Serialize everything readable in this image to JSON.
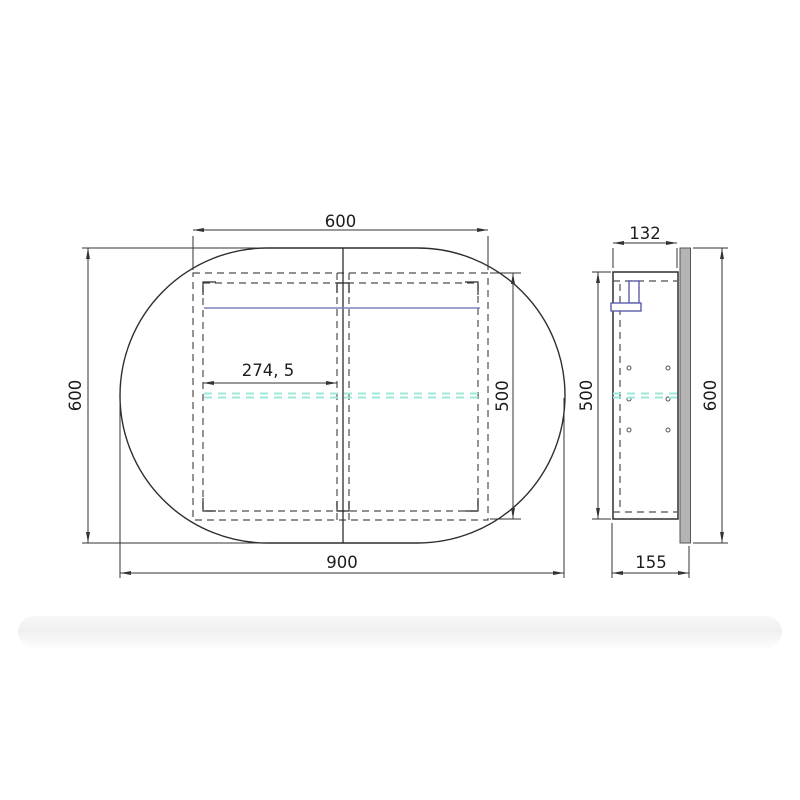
{
  "front_view": {
    "dims": {
      "cabinet_width": "600",
      "mirror_height": "600",
      "mirror_width": "900",
      "cabinet_height": "500",
      "hinge_offset": "274, 5"
    }
  },
  "side_view": {
    "dims": {
      "cabinet_depth": "132",
      "cabinet_height": "500",
      "mirror_height": "600",
      "overall_depth": "155"
    }
  },
  "colors": {
    "outline": "#2e2e2e",
    "dimension_line": "#333333",
    "hidden_line": "#4d4d4d",
    "led_strip": "#8080b8",
    "glass_shelf": "#9ce8da",
    "fitting_blue": "#5c5cae",
    "mirror_panel_fill": "#b4b4b4",
    "shadow_band": "#f1f1f1"
  }
}
